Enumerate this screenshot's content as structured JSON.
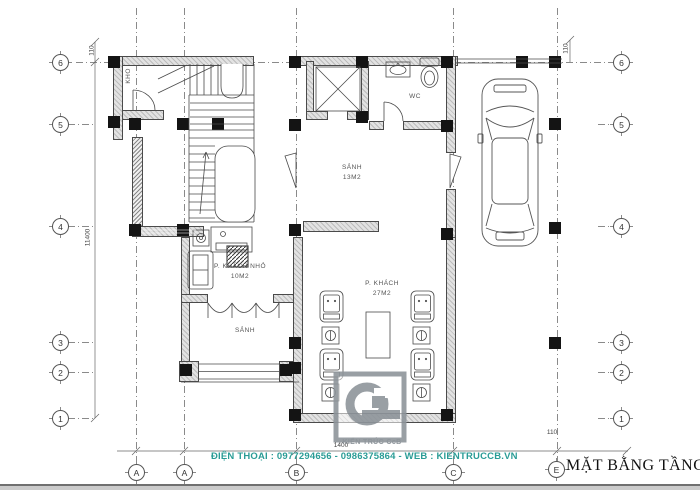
{
  "drawing": {
    "title": "MẶT BẰNG TẦNG 1",
    "contact": "ĐIỆN THOẠI : 0977294656 - 0986375864 - WEB : KIENTRUCCB.VN",
    "logo_text": "KIẾN TRÚC CcB"
  },
  "axes": {
    "rows": [
      "6",
      "5",
      "4",
      "3",
      "2",
      "1"
    ],
    "cols": [
      "A",
      "A",
      "B",
      "C"
    ],
    "title_marker": "E"
  },
  "rooms": {
    "kho": {
      "label": "KHO"
    },
    "wc": {
      "label": "WC"
    },
    "sanh_main": {
      "label": "SẢNH",
      "area": "13M2"
    },
    "khach_nho": {
      "label": "P. KHÁCH NHỎ",
      "area": "10M2"
    },
    "khach": {
      "label": "P. KHÁCH",
      "area": "27M2"
    },
    "sanh_front": {
      "label": "SẢNH"
    }
  },
  "dimensions": {
    "left_total": "11400",
    "top_left_offset": "110",
    "top_right_offset": "110",
    "bottom_right_offset": "110",
    "bottom_segment": "1400"
  },
  "colors": {
    "contact_text": "#2a9c96",
    "logo_gray": "#8e959b",
    "wall_fill": "#e2e2e2",
    "line": "#4a4a4a"
  }
}
